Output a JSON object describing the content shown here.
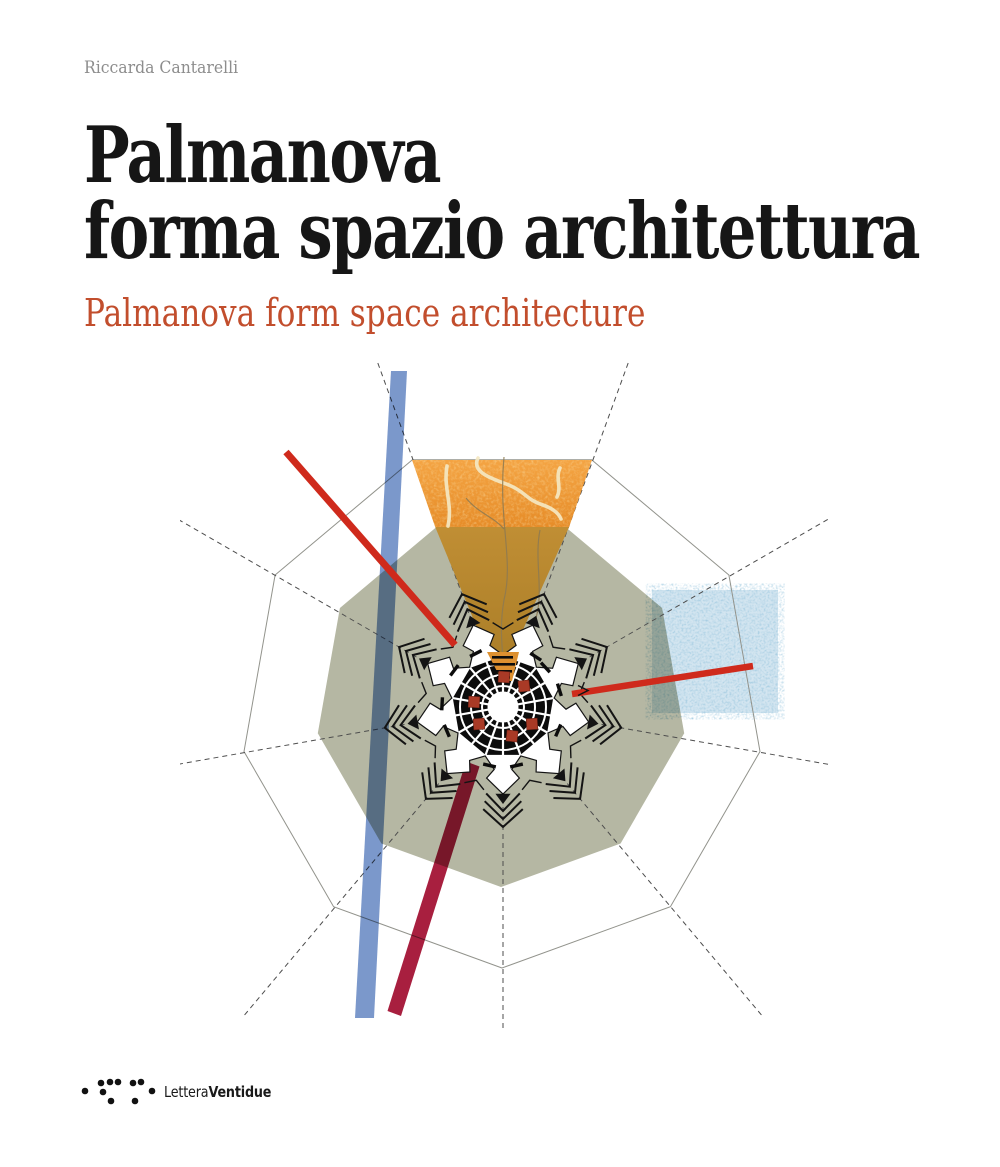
{
  "cover": {
    "author": "Riccarda Cantarelli",
    "title": {
      "line1": "Palmanova",
      "line2": "forma spazio architettura"
    },
    "subtitle": "Palmanova form space architecture",
    "publisher": {
      "regular": "Lettera",
      "bold": "Ventidue"
    }
  },
  "figure": {
    "description": "Schematic collage plan of the star-fort city of Palmanova: nonagonal glacis, radial survey lines, marble wedge, colored bars and textured square",
    "colors": {
      "olive": "#b5b7a3",
      "outer_line": "#92938c",
      "dash": "#4d4d4d",
      "ink": "#141414",
      "wedge_orange_light": "#f2a23e",
      "wedge_orange": "#e68c28",
      "wedge_dark_top": "#c08e34",
      "wedge_dark_bottom": "#a87c26",
      "vein": "#f5e8c2",
      "crack": "#8d7a52",
      "blue_bar": "#7b98cb",
      "crimson_bar": "#a81f3f",
      "red_line": "#cf2a1c",
      "square_blue": "#d3e5f0",
      "square_speckle_r": "0.30",
      "square_speckle_g": "0.55",
      "square_speckle_b": "0.72",
      "red_square": "#a93a26",
      "tip_orange": "#dd9030",
      "fort_white": "#ffffff",
      "city_black": "#0c0c0c"
    },
    "text_colors": {
      "title": "#161616",
      "subtitle": "#c24e2d",
      "author": "#8d8d8d",
      "publisher": "#1a1a1a"
    }
  }
}
